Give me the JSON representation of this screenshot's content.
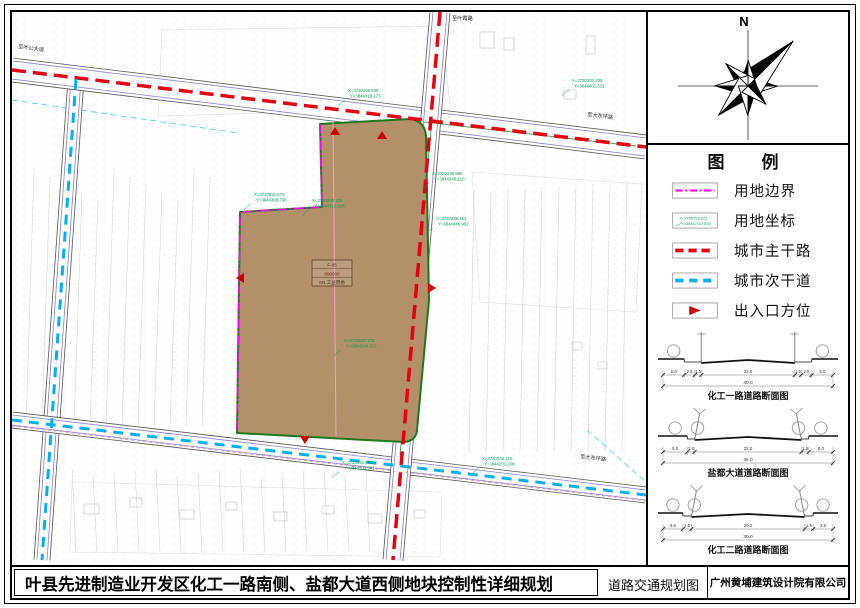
{
  "footer": {
    "title": "叶县先进制造业开发区化工一路南侧、盐都大道西侧地块控制性详细规划",
    "drawing_name": "道路交通规划图",
    "company": "广州黄埔建筑设计院有限公司"
  },
  "north": {
    "label": "N"
  },
  "legend": {
    "title": "图　例",
    "items": [
      {
        "id": "boundary",
        "label": "用地边界"
      },
      {
        "id": "coordinate",
        "label": "用地坐标",
        "sample": [
          "X=3708753.622",
          "Y=38447112.802"
        ]
      },
      {
        "id": "main-road",
        "label": "城市主干路"
      },
      {
        "id": "secondary-road",
        "label": "城市次干道"
      },
      {
        "id": "entrance",
        "label": "出入口方位"
      }
    ]
  },
  "sections": [
    {
      "caption": "化工一路道路断面图",
      "segments": [
        5.0,
        2.5,
        1.5,
        22.0,
        1.5,
        2.5,
        5.0
      ],
      "labels": [
        "5.0",
        "2.5",
        "1.5",
        "22.0",
        "1.5",
        "2.5",
        "5.0"
      ],
      "total": "40.0",
      "carriage": [
        3,
        4
      ],
      "poles": "T"
    },
    {
      "caption": "盐都大道道路断面图",
      "segments": [
        5.0,
        1.5,
        22.0,
        1.5,
        5.0
      ],
      "labels": [
        "5.0",
        "1.5",
        "22.0",
        "1.5",
        "5.0"
      ],
      "total": "35.0",
      "carriage": [
        2,
        3
      ],
      "poles": "Y"
    },
    {
      "caption": "化工二路道路断面图",
      "segments": [
        3.5,
        1.5,
        20.0,
        1.5,
        3.5
      ],
      "labels": [
        "3.5",
        "1.5",
        "20.0",
        "1.5",
        "3.5"
      ],
      "total": "30.0",
      "carriage": [
        2,
        3
      ],
      "poles": "Y"
    }
  ],
  "map": {
    "road_labels": [
      {
        "text": "至叶公大道",
        "x": 6,
        "y": 36,
        "rot": 8
      },
      {
        "text": "至叶霞路",
        "x": 440,
        "y": 8,
        "rot": 0
      },
      {
        "text": "至大东环路",
        "x": 575,
        "y": 104,
        "rot": 7
      },
      {
        "text": "至大东环路",
        "x": 568,
        "y": 446,
        "rot": 7
      }
    ],
    "coordinate_labels": [
      {
        "x": 336,
        "y": 80,
        "lines": [
          "X=3720296.939",
          "Y=3844318.173"
        ]
      },
      {
        "x": 560,
        "y": 70,
        "lines": [
          "X=3720301.205",
          "Y=3844401.332"
        ]
      },
      {
        "x": 242,
        "y": 184,
        "lines": [
          "X=3720091.675",
          "Y=3844308.756"
        ]
      },
      {
        "x": 300,
        "y": 190,
        "lines": [
          "X=3720090.125",
          "Y=3844312.508"
        ]
      },
      {
        "x": 420,
        "y": 163,
        "lines": [
          "X=3720289.885",
          "Y=3844348.120"
        ]
      },
      {
        "x": 424,
        "y": 208,
        "lines": [
          "X=3720286.153",
          "Y=3844346.981"
        ]
      },
      {
        "x": 332,
        "y": 330,
        "lines": [
          "X=3720087.175",
          "Y=3844294.931"
        ]
      },
      {
        "x": 330,
        "y": 452,
        "lines": [
          "X=3720052.613",
          "Y=3844203.581"
        ]
      },
      {
        "x": 470,
        "y": 448,
        "lines": [
          "X=3720048.316",
          "Y=3844201.268"
        ]
      }
    ],
    "parcel_label": [
      "F-05",
      "090000",
      "M1 工业用地"
    ],
    "colors": {
      "parcel": "#b3906a",
      "parcel_edge": "#1c7a1c",
      "boundary": "#ff00ff",
      "sub_divider": "#f2a0c8",
      "main_road": "#e60012",
      "secondary_road": "#00b0f0",
      "coord_text": "#00a050",
      "entrance": "#cc0000"
    }
  }
}
